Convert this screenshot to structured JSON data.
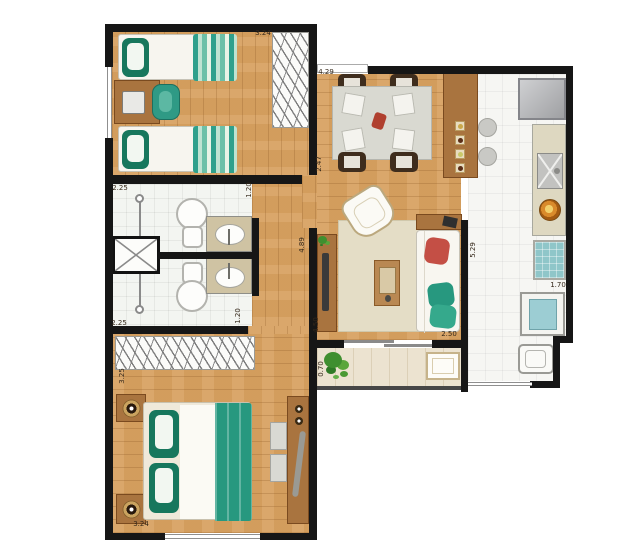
{
  "plan": {
    "type": "apartment-floor-plan",
    "unit": "m",
    "rooms": [
      {
        "id": "bedroom-1",
        "furniture": [
          "single-bed-icon",
          "single-bed-icon",
          "desk-icon",
          "desk-chair-icon",
          "wardrobe-icon"
        ]
      },
      {
        "id": "bathroom-1",
        "furniture": [
          "toilet-icon",
          "sink-vanity-icon",
          "shower-box-icon"
        ]
      },
      {
        "id": "bathroom-2",
        "furniture": [
          "toilet-icon",
          "sink-vanity-icon",
          "shower-box-icon"
        ]
      },
      {
        "id": "bedroom-2",
        "furniture": [
          "double-bed-icon",
          "nightstand-icon",
          "nightstand-icon",
          "wardrobe-icon",
          "dresser-icon"
        ]
      },
      {
        "id": "living-dining",
        "furniture": [
          "dining-table-icon",
          "chair-icon",
          "bar-counter-icon",
          "stool-icon",
          "armchair-icon",
          "rug-icon",
          "coffee-table-icon",
          "sofa-icon",
          "tv-sideboard-icon"
        ]
      },
      {
        "id": "kitchen",
        "furniture": [
          "refrigerator-icon",
          "counter-icon",
          "sink-icon",
          "cooktop-icon"
        ]
      },
      {
        "id": "service-area",
        "furniture": [
          "washing-machine-icon",
          "laundry-tank-icon"
        ]
      },
      {
        "id": "balcony",
        "furniture": [
          "plant-icon",
          "bench-icon"
        ]
      }
    ]
  },
  "labels": [
    {
      "text": "3.24",
      "meaning": "bedroom-1 width"
    },
    {
      "text": "2.47",
      "meaning": "bedroom-1 depth"
    },
    {
      "text": "2.25",
      "meaning": "bathroom block width top"
    },
    {
      "text": "1.20",
      "meaning": "bathroom-1 depth"
    },
    {
      "text": "1.20",
      "meaning": "bathroom-2 depth"
    },
    {
      "text": "2.25",
      "meaning": "bathroom block width bottom"
    },
    {
      "text": "3.25",
      "meaning": "bedroom-2 depth"
    },
    {
      "text": "3.24",
      "meaning": "bedroom-2 width"
    },
    {
      "text": "4.29",
      "meaning": "living-dining width"
    },
    {
      "text": "4.89",
      "meaning": "living-dining depth"
    },
    {
      "text": "4.50",
      "meaning": "living left lower dimension"
    },
    {
      "text": "2.50",
      "meaning": "balcony opening width"
    },
    {
      "text": "5.29",
      "meaning": "kitchen depth"
    },
    {
      "text": "0.70",
      "meaning": "balcony depth"
    },
    {
      "text": "1.70",
      "meaning": "service area width"
    }
  ],
  "colors": {
    "wall": "#161616",
    "wood_floor": "#d8a262",
    "wood_furniture": "#a9743f",
    "tile_floor": "#f3f5f1",
    "balcony_floor": "#ece3d0",
    "teal_accent": "#27987f",
    "red_accent": "#c44f45"
  }
}
